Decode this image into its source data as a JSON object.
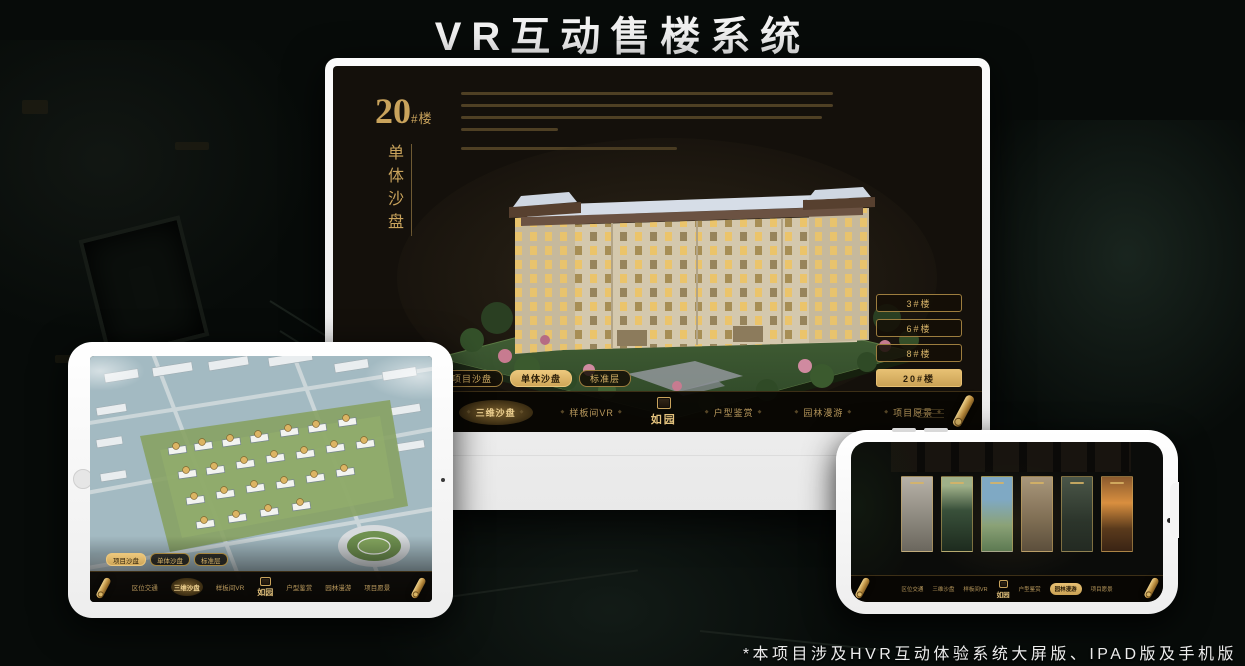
{
  "page": {
    "title": "VR互动售楼系统",
    "footnote": "*本项目涉及HVR互动体验系统大屏版、IPAD版及手机版"
  },
  "monitor": {
    "building_title": {
      "number": "20",
      "suffix": "#楼",
      "subtitle": "单体沙盘"
    },
    "floor_buttons": [
      {
        "label": "3#楼",
        "selected": false
      },
      {
        "label": "6#楼",
        "selected": false
      },
      {
        "label": "8#楼",
        "selected": false
      },
      {
        "label": "20#楼",
        "selected": true
      }
    ],
    "tabs": [
      {
        "label": "项目沙盘",
        "selected": false
      },
      {
        "label": "单体沙盘",
        "selected": true
      },
      {
        "label": "标准层",
        "selected": false
      }
    ],
    "nav": {
      "logo": "如园",
      "items": [
        {
          "label": "区位交通",
          "active": false
        },
        {
          "label": "三维沙盘",
          "active": true
        },
        {
          "label": "样板间VR",
          "active": false
        },
        {
          "label": "户型鉴赏",
          "active": false
        },
        {
          "label": "园林漫游",
          "active": false
        },
        {
          "label": "项目愿景",
          "active": false
        }
      ]
    }
  },
  "tablet": {
    "tabs": [
      {
        "label": "项目沙盘",
        "selected": true
      },
      {
        "label": "单体沙盘",
        "selected": false
      },
      {
        "label": "标准层",
        "selected": false
      }
    ],
    "nav": {
      "logo": "如园",
      "items": [
        {
          "label": "区位交通",
          "active": false
        },
        {
          "label": "三维沙盘",
          "active": true
        },
        {
          "label": "样板间VR",
          "active": false
        },
        {
          "label": "户型鉴赏",
          "active": false
        },
        {
          "label": "园林漫游",
          "active": false
        },
        {
          "label": "项目愿景",
          "active": false
        }
      ]
    }
  },
  "phone": {
    "nav": {
      "logo": "如园",
      "items": [
        {
          "label": "区位交通",
          "active": false
        },
        {
          "label": "三维沙盘",
          "active": false
        },
        {
          "label": "样板间VR",
          "active": false
        },
        {
          "label": "户型鉴赏",
          "active": false
        },
        {
          "label": "园林漫游",
          "active": true
        },
        {
          "label": "项目愿景",
          "active": false
        }
      ]
    }
  },
  "colors": {
    "gold": "#c9a35c",
    "gold_bright": "#e8c87e",
    "screen_bg": "#14100b",
    "background": "#070b09",
    "device_body": "#f2f2f2"
  }
}
